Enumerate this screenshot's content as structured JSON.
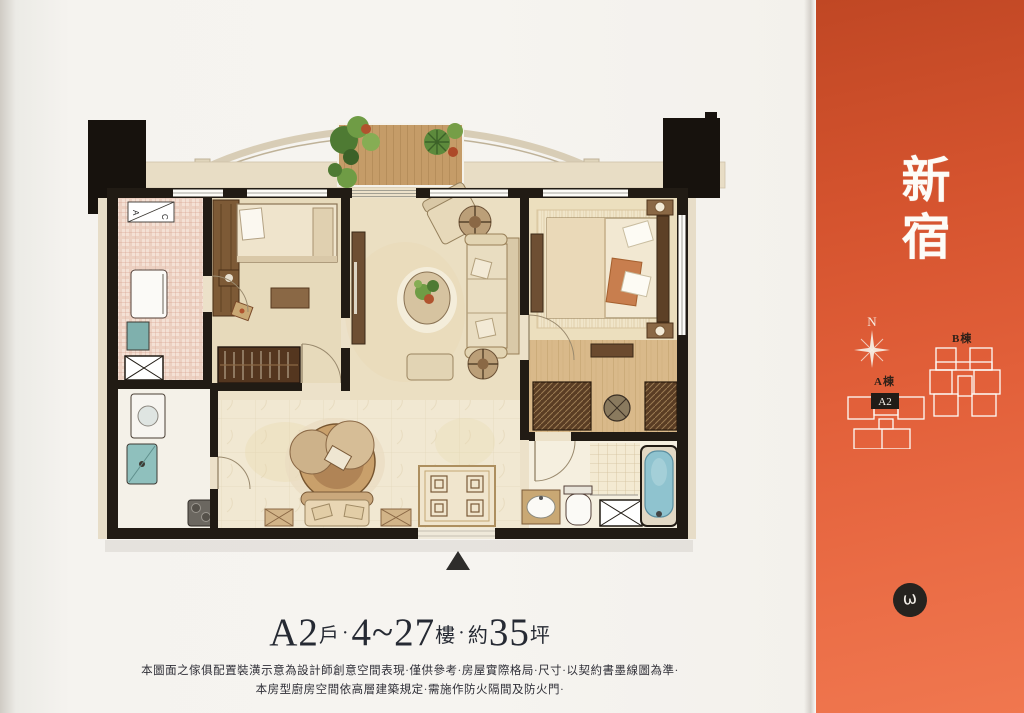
{
  "plan": {
    "title": {
      "unit": "A2",
      "unit_label": "戶",
      "dot1": "·",
      "floors": "4~27",
      "floors_label": "樓",
      "dot2": "·",
      "approx_label": "約",
      "area": "35",
      "area_label": "坪"
    },
    "disclaimer": {
      "line1": "本圖面之傢俱配置裝潢示意為設計師創意空間表現·僅供參考·房屋實際格局·尺寸·以契約書墨線圖為準·",
      "line2": "本房型廚房空間依高層建築規定·需施作防火隔間及防火門·"
    },
    "ac_box": {
      "a": "A",
      "c": "C"
    }
  },
  "sidebar": {
    "project_title_char1": "新",
    "project_title_char2": "宿",
    "compass_label": "N",
    "site_plan": {
      "building_a": "A棟",
      "building_b": "B棟",
      "unit": "A2"
    },
    "badge_glyph": "ω"
  },
  "colors": {
    "accent_top": "#c04724",
    "accent_bottom": "#f0774f",
    "wall": "#211b14",
    "bath_blue": "#8fc3cf"
  }
}
